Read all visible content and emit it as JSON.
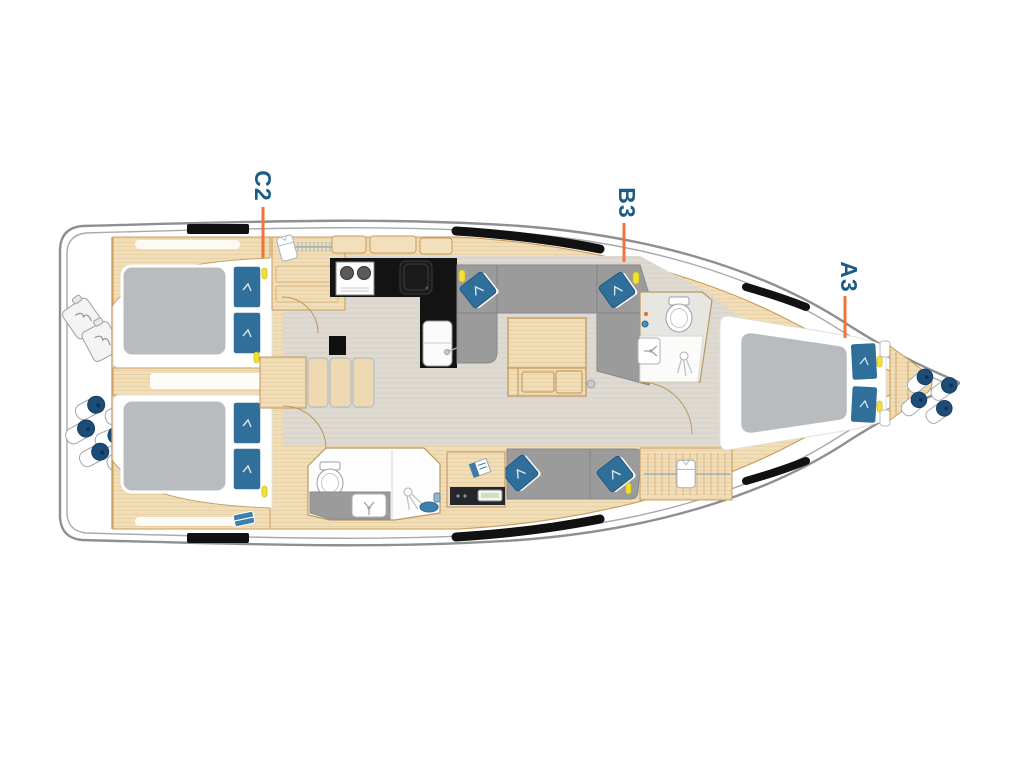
{
  "diagram": {
    "type": "yacht-deck-floor-plan",
    "orientation": "bow-right",
    "cabin_labels": [
      {
        "code": "C2",
        "area": "port-aft-cabin"
      },
      {
        "code": "B3",
        "area": "saloon-berth"
      },
      {
        "code": "A3",
        "area": "forward-cabin"
      }
    ],
    "colors": {
      "background": "#ffffff",
      "label_text": "#1b5c84",
      "leader_line": "#f47139",
      "hull_outline": "#8d8f90",
      "wood": "#f0ddba",
      "wood_outline": "#c99a5b",
      "floor": "#dedad2",
      "sofa_gray": "#9c9b9c",
      "mattress_gray": "#b9bcbf",
      "pillow_blue": "#2f6f9a",
      "window_black": "#111111",
      "fender_navy": "#1d4d77",
      "accent_yellow": "#f2e136"
    },
    "icons": [
      "toilet-icon",
      "shower-icon",
      "sink-icon",
      "stove-icon",
      "clothes-hanger-icon",
      "fender-icon",
      "jug-icon",
      "pillow-icon",
      "bath-mat-icon",
      "nav-instrument-icon"
    ]
  }
}
